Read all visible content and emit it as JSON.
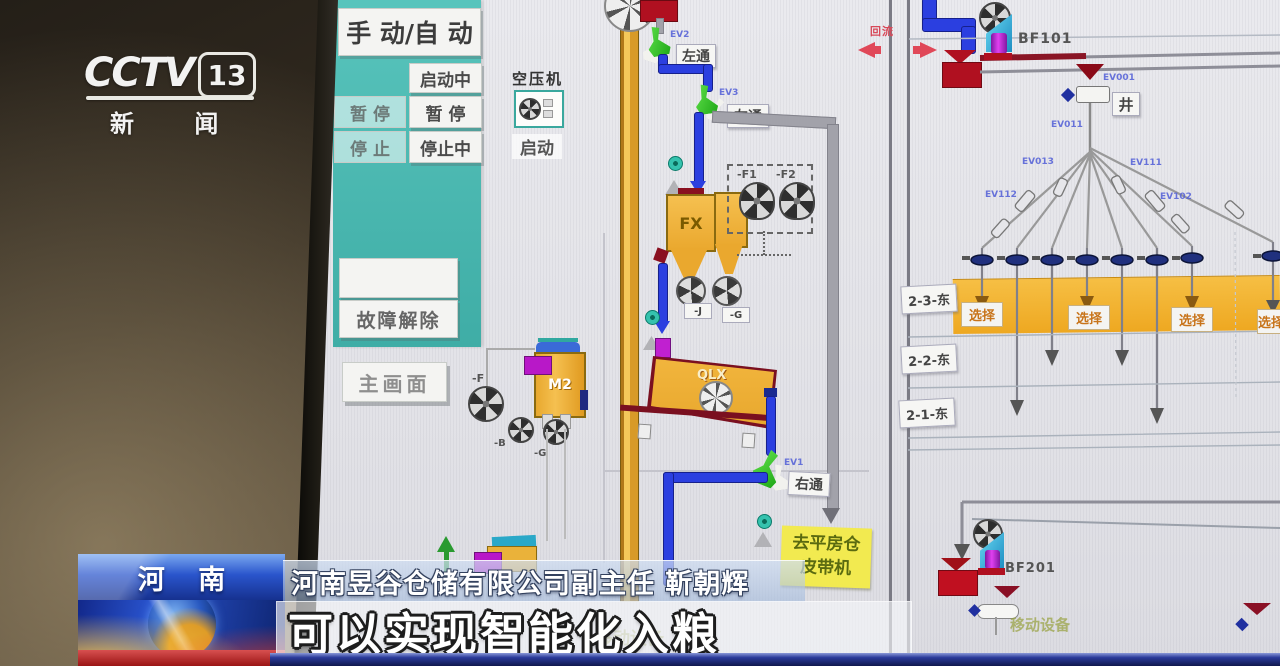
{
  "broadcast": {
    "channel": {
      "name": "CCTV",
      "number": "13",
      "tagline": "新 闻"
    },
    "region_tag": "河 南",
    "speaker_line": "河南昱谷仓储有限公司副主任 靳朝辉",
    "caption": "可以实现智能化入粮"
  },
  "scada": {
    "panel": {
      "mode": "手 动/自 动",
      "starting": "启动中",
      "pause_left": "暂 停",
      "pause_right": "暂 停",
      "stop_left": "停 止",
      "stopping": "停止中",
      "fault_clear": "故障解除",
      "main_screen": "主画面",
      "compressor": "空压机",
      "compressor_start": "启动"
    },
    "flow": {
      "ev2": "EV2",
      "ev3": "EV3",
      "ev1": "EV1",
      "left_pass": "左通",
      "right_pass": "右通",
      "fx": "FX",
      "m2": "M2",
      "qlx": "QLX",
      "fan_f": "-F",
      "fan_b": "-B",
      "fan_g": "-G",
      "fan_f1": "-F1",
      "fan_f2": "-F2",
      "valve_j": "-J",
      "valve_g": "-G",
      "dest_line1": "去平房仓",
      "dest_line2": "皮带机",
      "faint_equipment": "移动设备"
    },
    "right": {
      "bf101": "BF101",
      "bf201": "BF201",
      "reflux": "回流",
      "well": "井",
      "rows": [
        "2-3-东",
        "2-2-东",
        "2-1-东"
      ],
      "select": "选择",
      "valve_ids": [
        "EV001",
        "EV011",
        "EV013",
        "EV111",
        "EV112",
        "EV102"
      ]
    },
    "colors": {
      "teal": "#49b9b1",
      "orange": "#f0b23c",
      "pipe_blue": "#2b3fe0",
      "band_yellow": "#f2b22c",
      "valve_green": "#3ed32e",
      "alarm_red": "#c01818",
      "magenta": "#b818c8",
      "cyan": "#35b6e6"
    }
  }
}
